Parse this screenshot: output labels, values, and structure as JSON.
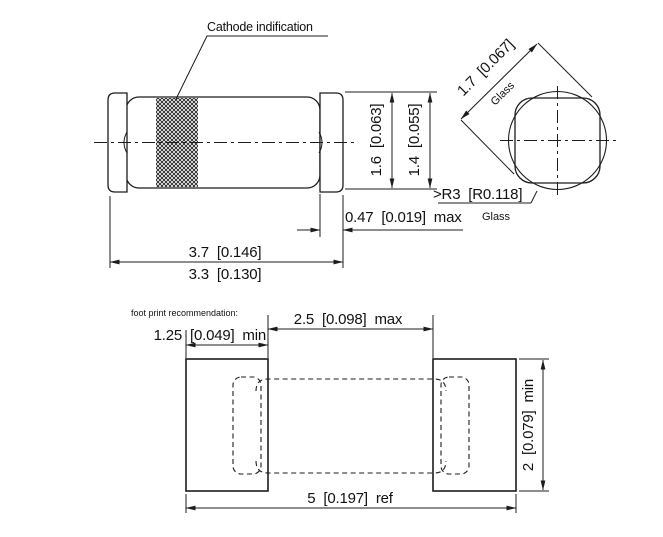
{
  "colors": {
    "line": "#1c1c1c",
    "text": "#111111",
    "background": "#ffffff"
  },
  "side_view": {
    "cathode_label": "Cathode indification",
    "cap_diameter": "1.6 [0.063]",
    "glass_diameter": "1.4 [0.055]",
    "cap_length": "0.47 [0.019] max",
    "overall_length": "3.7 [0.146]",
    "glass_length": "3.3 [0.130]"
  },
  "end_view": {
    "diagonal": "1.7 [0.067]",
    "diagonal_material": "Glass",
    "corner_radius": ">R3 [R0.118]",
    "corner_material": "Glass"
  },
  "footprint": {
    "title": "foot print recommendation:",
    "pad_width": "1.25 [0.049] min",
    "pad_gap": "2.5 [0.098] max",
    "overall": "5 [0.197] ref",
    "pad_height": "2 [0.079] min"
  }
}
